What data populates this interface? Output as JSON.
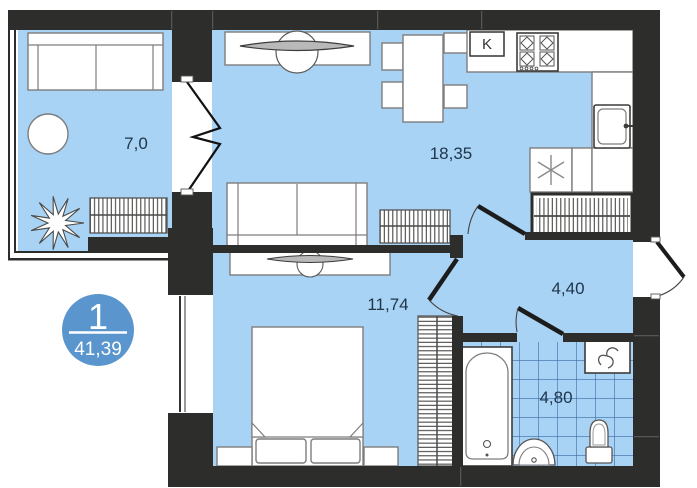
{
  "plan": {
    "badge": {
      "number": "1",
      "total_area": "41,39"
    },
    "kitchen_marker": "K",
    "rooms": [
      {
        "id": "balcony",
        "area_label": "7,0"
      },
      {
        "id": "living-kitchen",
        "area_label": "18,35"
      },
      {
        "id": "bedroom",
        "area_label": "11,74"
      },
      {
        "id": "hallway",
        "area_label": "4,40"
      },
      {
        "id": "bathroom",
        "area_label": "4,80"
      }
    ],
    "colors": {
      "floor": "#a9d3f5",
      "wall": "#2d2d2b",
      "badge": "#5a96cd",
      "tile_line": "#3a6aa5"
    },
    "icons": [
      "sofa-icon",
      "round-table-icon",
      "plant-icon",
      "radiator-icon",
      "tv-icon",
      "dining-table-icon",
      "chair-icon",
      "stove-icon",
      "kitchen-sink-icon",
      "fridge-snowflake-icon",
      "wardrobe-icon",
      "bed-icon",
      "nightstand-icon",
      "bathtub-icon",
      "washing-machine-icon",
      "washbasin-icon",
      "toilet-icon",
      "door-swing-icon",
      "balcony-door-icon",
      "window-icon"
    ]
  }
}
